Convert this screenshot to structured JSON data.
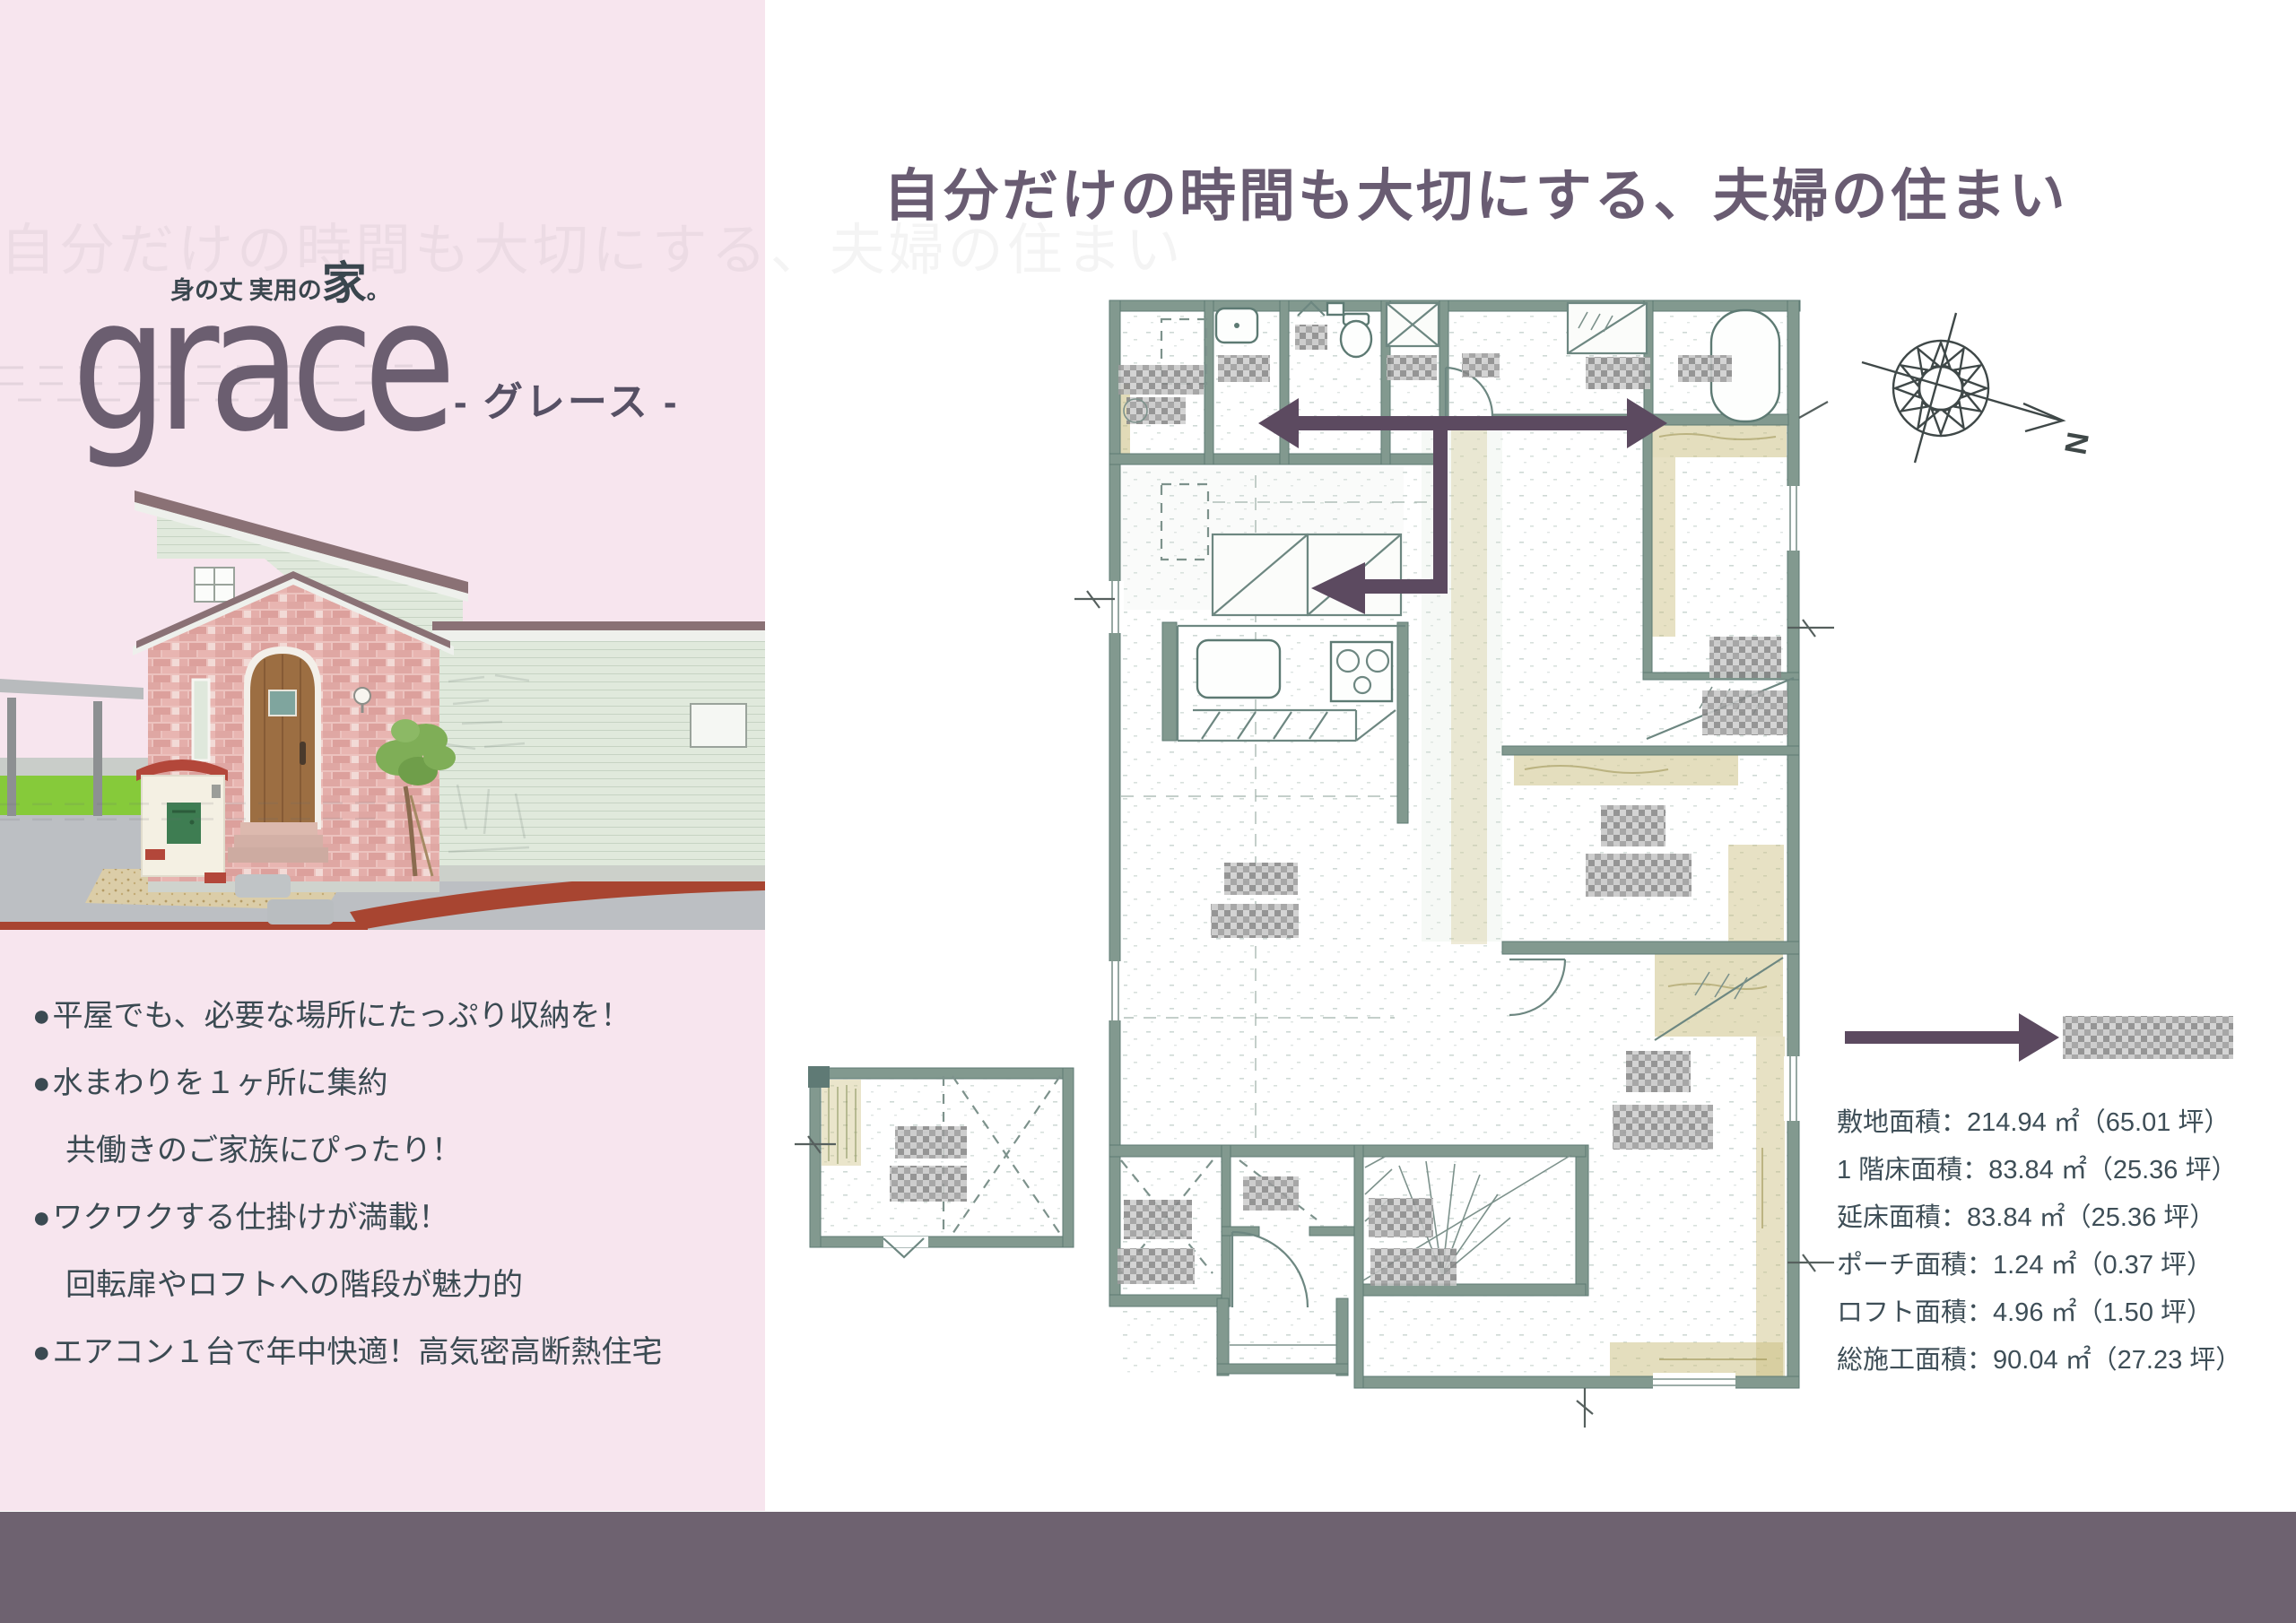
{
  "sidebar": {
    "brand_tagline": {
      "main": "身の丈 実用の",
      "big": "家",
      "period": "。"
    },
    "brand": "grace",
    "brand_reading": "- グレース -",
    "bullets": [
      {
        "marker": "●",
        "text": "平屋でも、必要な場所にたっぷり収納を！"
      },
      {
        "marker": "●",
        "text": "水まわりを１ヶ所に集約"
      },
      {
        "marker": "",
        "text": "共働きのご家族にぴったり！"
      },
      {
        "marker": "●",
        "text": "ワクワクする仕掛けが満載！"
      },
      {
        "marker": "",
        "text": "回転扉やロフトへの階段が魅力的"
      },
      {
        "marker": "●",
        "text": "エアコン１台で年中快適！高気密高断熱住宅"
      }
    ]
  },
  "main": {
    "title": "自分だけの時間も大切にする、夫婦の住まい",
    "compass_label": "N",
    "area_details": [
      "敷地面積：214.94 ㎡（65.01 坪）",
      "1 階床面積：83.84 ㎡（25.36 坪）",
      "延床面積：83.84 ㎡（25.36 坪）",
      "ポーチ面積：1.24 ㎡（0.37 坪）",
      "ロフト面積：4.96 ㎡（1.50 坪）",
      "総施工面積：90.04 ㎡（27.23 坪）"
    ],
    "floor_plan": {
      "room_labels_censored": true
    }
  },
  "colors": {
    "sidebar_bg": "#f7e5ee",
    "footer_bar": "#6e6270",
    "accent_arrow": "#5c4a60",
    "title_text": "#695c72",
    "body_text": "#3b4a52",
    "brand_text": "#6b5e70",
    "plan_wall": "#82998f",
    "plan_tatami": "#cabd7d"
  }
}
